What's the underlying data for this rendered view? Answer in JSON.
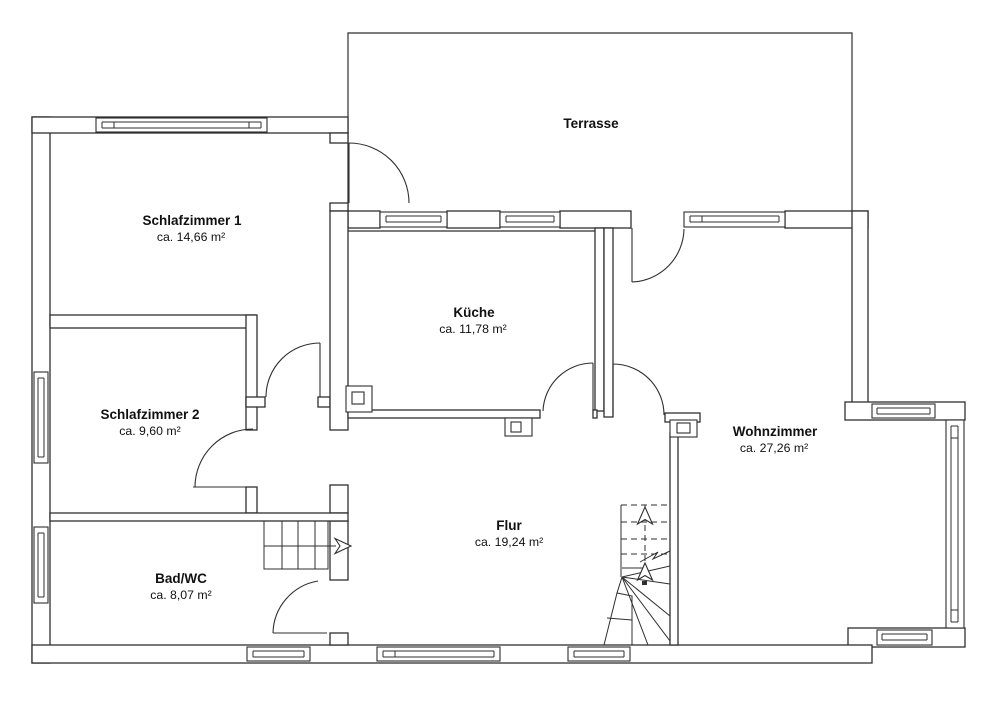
{
  "colors": {
    "line": "#2f2f2f",
    "text": "#111111",
    "background": "#ffffff"
  },
  "rooms": [
    {
      "id": "terrasse",
      "name": "Terrasse",
      "area": ""
    },
    {
      "id": "schlafzimmer-1",
      "name": "Schlafzimmer 1",
      "area": "ca. 14,66 m²"
    },
    {
      "id": "kueche",
      "name": "Küche",
      "area": "ca. 11,78 m²"
    },
    {
      "id": "schlafzimmer-2",
      "name": "Schlafzimmer 2",
      "area": "ca. 9,60 m²"
    },
    {
      "id": "wohnzimmer",
      "name": "Wohnzimmer",
      "area": "ca. 27,26 m²"
    },
    {
      "id": "flur",
      "name": "Flur",
      "area": "ca. 19,24 m²"
    },
    {
      "id": "bad-wc",
      "name": "Bad/WC",
      "area": "ca. 8,07 m²"
    }
  ]
}
